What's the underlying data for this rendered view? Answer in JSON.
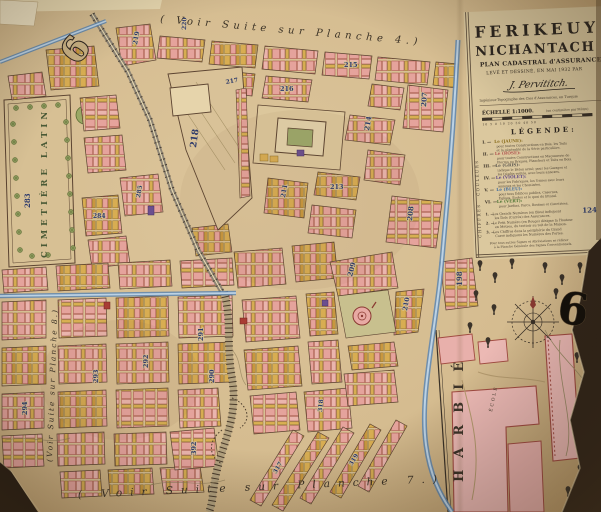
{
  "plate": {
    "number_left": "6",
    "number_right": "6"
  },
  "borders": {
    "top": "( Voir Suite sur Planche 4.)",
    "bottom": "( Voir  Suite  sur  Planche  7.)",
    "left": "(Voir Suite sur Planche 8.)"
  },
  "title_block": {
    "name_line1": "FERIKEUY",
    "name_line2": "NICHANTACH",
    "subtitle": "PLAN CADASTRAL d'ASSURANCES",
    "credit": "LEVÉ ET DESSINÉ, EN MAI 1932 PAR",
    "signature": "J. Pervititch.",
    "profession": "Ingénieur-Topographe des Cies d'Assurances, en Turquie",
    "scale": "ÉCHELLE 1:1000.",
    "scale_note": "(un centimètre par Mètre)",
    "scale_ticks": "10   5   0   10   20   30   40   50",
    "legend_title": "LÉGENDE:"
  },
  "legend": {
    "couleurs_label": "COULEURS",
    "chiffres_label": "CHIFFRES",
    "sample_number": "124",
    "items": [
      {
        "numeral": "I. —",
        "word": "Le (JAUNE):",
        "color": "#8a6d1c",
        "line1": "pour toutes Constructions en Bois, les Toits",
        "line2": "et la généralité de la Série particulière."
      },
      {
        "numeral": "II. —",
        "word": "Le (ROSE):",
        "color": "#b05550",
        "line1": "pour toutes Constructions en Maçonnerie de",
        "line2": "Pierres ou Briques, Planchers et Toits en Bois."
      },
      {
        "numeral": "III. —",
        "word": "Le (GRIS):",
        "color": "#5f5a52",
        "line1": "indique le Béton armé; pour les Garages et",
        "line2": "les Dépôts voûtés, avec leurs annexes."
      },
      {
        "numeral": "IV. —",
        "word": "Le (VIOLET):",
        "color": "#5d4585",
        "line1": "pour les Fabriques, les Usines avec leurs",
        "line2": "annexes et les Cheminées."
      },
      {
        "numeral": "V. —",
        "word": "Le (BLEU):",
        "color": "#3f6b9e",
        "line1": "pour tous Édifices publics, Casernes,",
        "line2": "Églises, Écoles et le quai du littoral."
      },
      {
        "numeral": "VI. —",
        "word": "Le (VERT):",
        "color": "#4d7433",
        "line1": "pour Jardins, Parcs, Bostans et Cimetières.",
        "line2": ""
      }
    ],
    "chiffres_items": [
      {
        "numeral": "1. —",
        "line1": "Les Grands Numéros (en Bleu) indiquent",
        "line2": "les Îlots (Carrés) des Assurances."
      },
      {
        "numeral": "2. —",
        "line1": "Le Petit Numéro (en Rouge) désigne la Hauteur",
        "line2": "en Mètres, du trottoir au toit de la Maison."
      },
      {
        "numeral": "3. —",
        "line1": "Les Chiffres dans la périphérie du Grand",
        "line2": "Carré indiquent les Numéros des Portes."
      }
    ],
    "footer1": "Pour tous autres Signes et Abréviations se référer",
    "footer2": "à la Planche Générale des Signes Conventionnels."
  },
  "map": {
    "cemetery_label": "CIMETIÈRE  LATIN",
    "school_name": "HARBIÉ",
    "school_sub": "ÉCOLE",
    "blocks": [
      {
        "label": "220"
      },
      {
        "label": "219"
      },
      {
        "label": "218"
      },
      {
        "label": "217"
      },
      {
        "label": "216"
      },
      {
        "label": "215"
      },
      {
        "label": "214"
      },
      {
        "label": "213"
      },
      {
        "label": "211"
      },
      {
        "label": "208"
      },
      {
        "label": "207"
      },
      {
        "label": "209"
      },
      {
        "label": "210"
      },
      {
        "label": "198"
      },
      {
        "label": "283"
      },
      {
        "label": "284"
      },
      {
        "label": "285"
      },
      {
        "label": "290"
      },
      {
        "label": "291"
      },
      {
        "label": "292"
      },
      {
        "label": "293"
      },
      {
        "label": "294"
      },
      {
        "label": "392"
      },
      {
        "label": "318"
      },
      {
        "label": "317"
      },
      {
        "label": "319"
      }
    ]
  }
}
